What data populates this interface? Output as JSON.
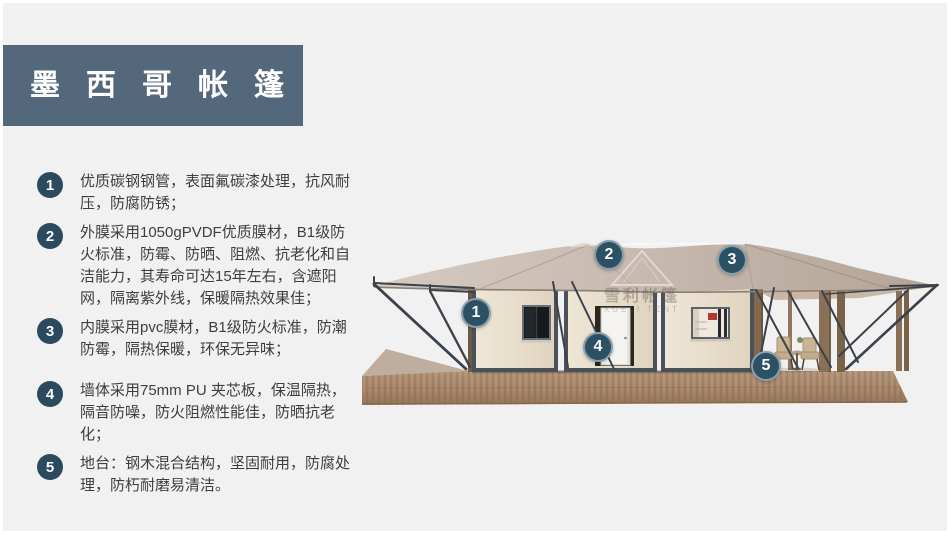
{
  "banner": {
    "title": "墨西哥帐篷",
    "bg_color": "#54687c",
    "text_color": "#ffffff"
  },
  "features": {
    "badge_color": "#2b4a5e",
    "items": [
      {
        "num": "1",
        "text": "优质碳钢钢管，表面氟碳漆处理，抗风耐压，防腐防锈；"
      },
      {
        "num": "2",
        "text": "外膜采用1050gPVDF优质膜材，B1级防火标准，防霉、防晒、阻燃、抗老化和自洁能力，其寿命可达15年左右，含遮阳网，隔离紫外线，保暖隔热效果佳；"
      },
      {
        "num": "3",
        "text": "内膜采用pvc膜材，B1级防火标准，防潮防霉，隔热保暖，环保无异味；"
      },
      {
        "num": "4",
        "text": "墙体采用75mm PU 夹芯板，保温隔热，隔音防噪，防火阻燃性能佳，防晒抗老化；"
      },
      {
        "num": "5",
        "text": "地台：钢木混合结构，坚固耐用，防腐处理，防朽耐磨易清洁。"
      }
    ]
  },
  "tent": {
    "callouts": [
      {
        "label": "1"
      },
      {
        "label": "2"
      },
      {
        "label": "3"
      },
      {
        "label": "4"
      },
      {
        "label": "5"
      }
    ],
    "watermark": {
      "cn": "雪利帐篷",
      "en": "XUELI TENT"
    },
    "colors": {
      "canopy": "#c6b8ac",
      "wall": "#ece4d3",
      "frame": "#4b5158",
      "deck": "#a5876b",
      "steel": "#3b424b",
      "callout": "#2c5164"
    }
  }
}
